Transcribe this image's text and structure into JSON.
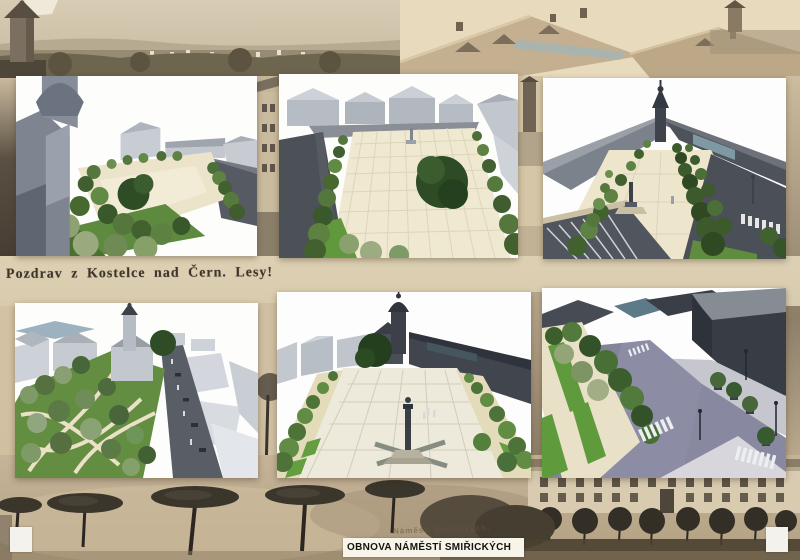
{
  "texts": {
    "postcard_caption": "Pozdrav z Kostelce nad Čern. Lesy!",
    "old_square_caption": "Náměstí Smiřických,",
    "poster_title": "OBNOVA NÁMĚSTÍ SMIŘICKÝCH"
  },
  "panels": [
    {
      "id": "render-top-left",
      "content": "aerial view of square beside baroque church tower, tree rows, road at right"
    },
    {
      "id": "render-top-center",
      "content": "bird's-eye view of gridded square with central column, large tree, flanking tree alleys, dark road left"
    },
    {
      "id": "render-top-right",
      "content": "long view toward church tower, converging tree alleys, column, road with crosswalk, parking in foreground"
    },
    {
      "id": "render-bottom-left",
      "content": "aerial view of green park with winding paths around church with spire, road with cars at right"
    },
    {
      "id": "render-bottom-center",
      "content": "square with dark church tower, long dark roofline right, grid paving, column monument on stepped base"
    },
    {
      "id": "render-bottom-right",
      "content": "street-level view of cobbled intersection with zebra crossings, lawn strips, tree rows, dark building right"
    }
  ],
  "background": {
    "photos": [
      "sepia town panorama with church tower (top left)",
      "sepia rooftops with small tower (top right)",
      "old facade fragments between render panels",
      "sepia square with pollarded trees (bottom left)",
      "sepia two-story facades with round trees (bottom right)"
    ]
  },
  "colors": {
    "postcard_base": "#d2c1a2",
    "cream_band": "#ddd0b3",
    "render_sky": "#fdfdfc",
    "pavement_cream": "#ede5cc",
    "tree_green_dark": "#2e4d26",
    "tree_green_mid": "#55773d",
    "lawn_green": "#5f9a3c",
    "road_gray": "#4e535b",
    "cobble_violet": "#8c8ca4",
    "massing_gray": "#b6bcc4",
    "title_ink": "#15130f",
    "caption_ink": "#3e342a"
  }
}
